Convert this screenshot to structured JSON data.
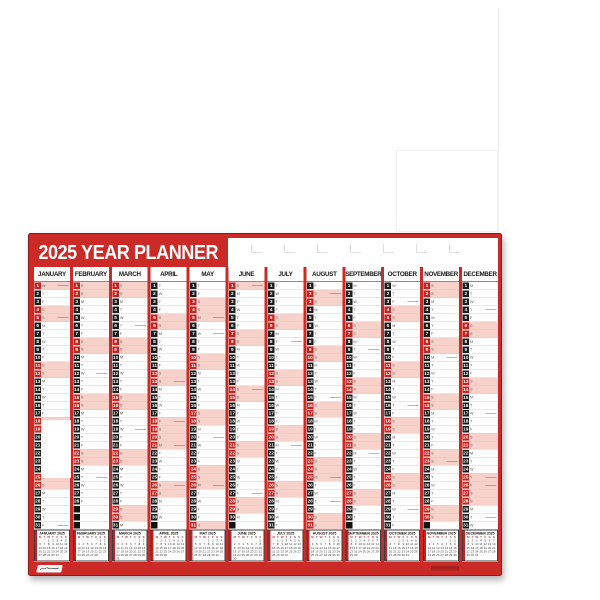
{
  "planner": {
    "title": "2025 YEAR PLANNER",
    "year": "2025",
    "day_letters": [
      "M",
      "T",
      "W",
      "T",
      "F",
      "S",
      "S"
    ],
    "colors": {
      "frame_red": "#cb2a26",
      "deep_red": "#8e1a17",
      "box_black": "#1c1c1c",
      "box_red": "#c7211f",
      "row_pink": "#f7d2ca"
    },
    "months": [
      {
        "name": "JANUARY",
        "mini_title": "JANUARY 2025",
        "days": 31,
        "start_dow": 2,
        "holidays": [
          1
        ]
      },
      {
        "name": "FEBRUARY",
        "mini_title": "FEBRUARY 2025",
        "days": 28,
        "start_dow": 5,
        "holidays": []
      },
      {
        "name": "MARCH",
        "mini_title": "MARCH 2025",
        "days": 31,
        "start_dow": 5,
        "holidays": []
      },
      {
        "name": "APRIL",
        "mini_title": "APRIL 2025",
        "days": 30,
        "start_dow": 1,
        "holidays": [
          18,
          21
        ]
      },
      {
        "name": "MAY",
        "mini_title": "MAY 2025",
        "days": 31,
        "start_dow": 3,
        "holidays": [
          5,
          26
        ]
      },
      {
        "name": "JUNE",
        "mini_title": "JUNE 2025",
        "days": 30,
        "start_dow": 6,
        "holidays": []
      },
      {
        "name": "JULY",
        "mini_title": "JULY 2025",
        "days": 31,
        "start_dow": 1,
        "holidays": []
      },
      {
        "name": "AUGUST",
        "mini_title": "AUGUST 2025",
        "days": 31,
        "start_dow": 4,
        "holidays": [
          25
        ]
      },
      {
        "name": "SEPTEMBER",
        "mini_title": "SEPTEMBER 2025",
        "days": 30,
        "start_dow": 0,
        "holidays": []
      },
      {
        "name": "OCTOBER",
        "mini_title": "OCTOBER 2025",
        "days": 31,
        "start_dow": 2,
        "holidays": []
      },
      {
        "name": "NOVEMBER",
        "mini_title": "NOVEMBER 2025",
        "days": 30,
        "start_dow": 5,
        "holidays": []
      },
      {
        "name": "DECEMBER",
        "mini_title": "DECEMBER 2025",
        "days": 31,
        "start_dow": 0,
        "holidays": [
          25,
          26
        ]
      }
    ],
    "logo_icon": "brand-scribble-logo"
  }
}
